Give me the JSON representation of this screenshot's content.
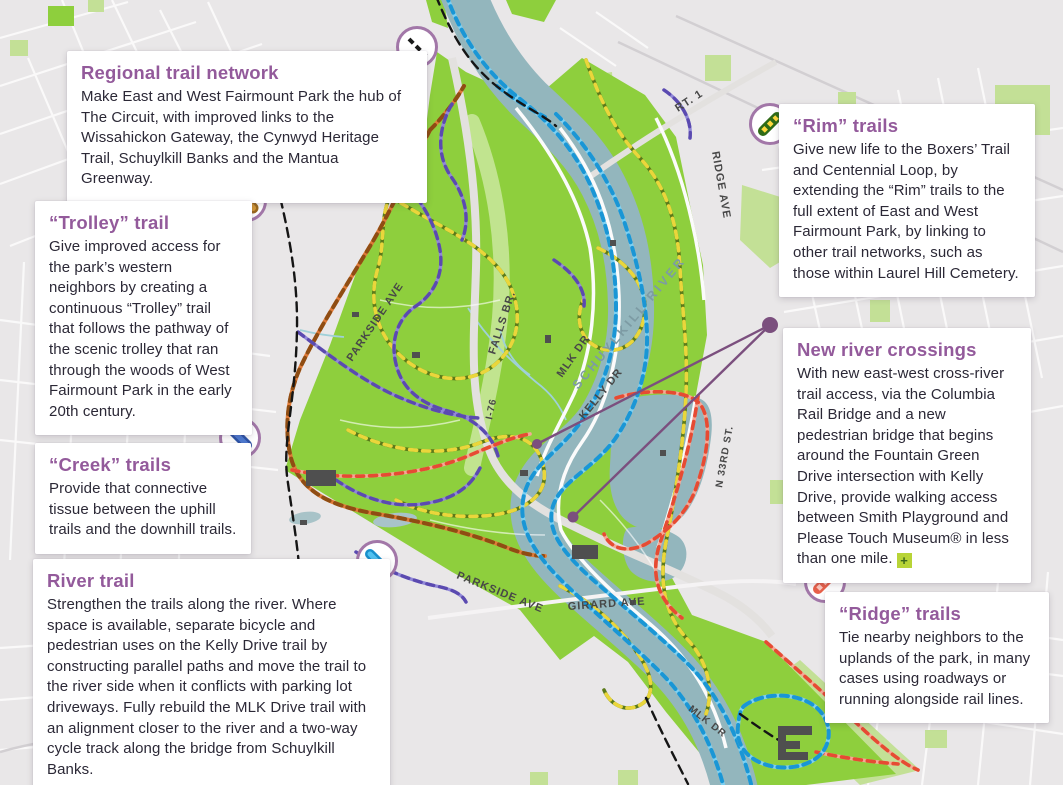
{
  "callouts": {
    "regional": {
      "title": "Regional trail network",
      "body": "Make East and West Fairmount Park the hub of The Circuit, with improved links to the Wissahickon Gateway, the Cynwyd Heritage Trail, Schuylkill Banks and the Mantua Greenway."
    },
    "trolley": {
      "title": "“Trolley” trail",
      "body": "Give improved access for the park’s western neighbors by creating a continuous “Trolley” trail that follows the pathway of the scenic trolley that ran through the woods of West Fairmount Park in the early 20th century."
    },
    "creek": {
      "title": "“Creek” trails",
      "body": "Provide that connective tissue between the uphill trails and the downhill trails."
    },
    "river": {
      "title": "River trail",
      "body": "Strengthen the trails along the river. Where space is available, separate bicycle and pedestrian uses on the Kelly Drive trail by constructing parallel paths and move the trail to the river side when it conflicts with parking lot driveways. Fully rebuild the MLK Drive trail with an alignment closer to the river and a two-way cycle track along the bridge from Schuylkill Banks."
    },
    "rim": {
      "title": "“Rim” trails",
      "body": "Give new life to the Boxers’ Trail and Centennial Loop, by extending the “Rim” trails to the full extent of East and West Fairmount Park, by linking to other trail networks, such as those within Laurel Hill Cemetery."
    },
    "crossings": {
      "title": "New river crossings",
      "body": "With new east-west cross-river trail access, via the Columbia Rail Bridge and a new pedestrian bridge that begins around the Fountain Green Drive intersection with Kelly Drive, provide walking access between Smith Playground and Please Touch Museum® in less than one mile.",
      "plus_label": "+"
    },
    "ridge": {
      "title": "“Ridge” trails",
      "body": "Tie nearby neighbors to the uplands of the park, in many cases using roadways or running alongside rail lines."
    }
  },
  "map": {
    "labels": {
      "falls_br": "FALLS BR.",
      "rt1": "RT. 1",
      "ridge_ave": "RIDGE AVE",
      "parkside_ave_upper": "PARKSIDE AVE",
      "mlk_dr": "MLK DR",
      "schuylkill_river": "SCHUYLKILL RIVER",
      "kelly_dr": "KELLY DR",
      "i76": "I-76",
      "n_33rd_st": "N 33RD ST.",
      "parkside_ave_lower": "PARKSIDE AVE",
      "girard_ave": "GIRARD AVE",
      "mlk_dr_lower": "MLK DR"
    },
    "icons": {
      "regional": "black-dashed-line-icon",
      "trolley": "orange-stripe-icon",
      "creek": "blue-stripe-icon",
      "river": "light-blue-stripe-icon",
      "rim": "green-yellow-dashed-stripe-icon",
      "ridge": "pink-dashed-stripe-icon"
    }
  },
  "colors": {
    "heading_accent": "#935a9b",
    "circle_border": "#a277a8",
    "body_text": "#2b2836",
    "park_green": "#8ecf3d",
    "light_green": "#c3e096",
    "river_blue_gray": "#93b6bd",
    "trail_river_blue": "#1a96d5",
    "trail_rim_olive": "#5b7a1a",
    "trail_rim_dash_yellow": "#ead63b",
    "trail_trolley_orange": "#8f4d13",
    "trail_creek_purple": "#5b4ab0",
    "trail_ridge_red": "#e64b33",
    "crossing_purple": "#7b4f7e",
    "plus_badge_green": "#b8d437"
  }
}
